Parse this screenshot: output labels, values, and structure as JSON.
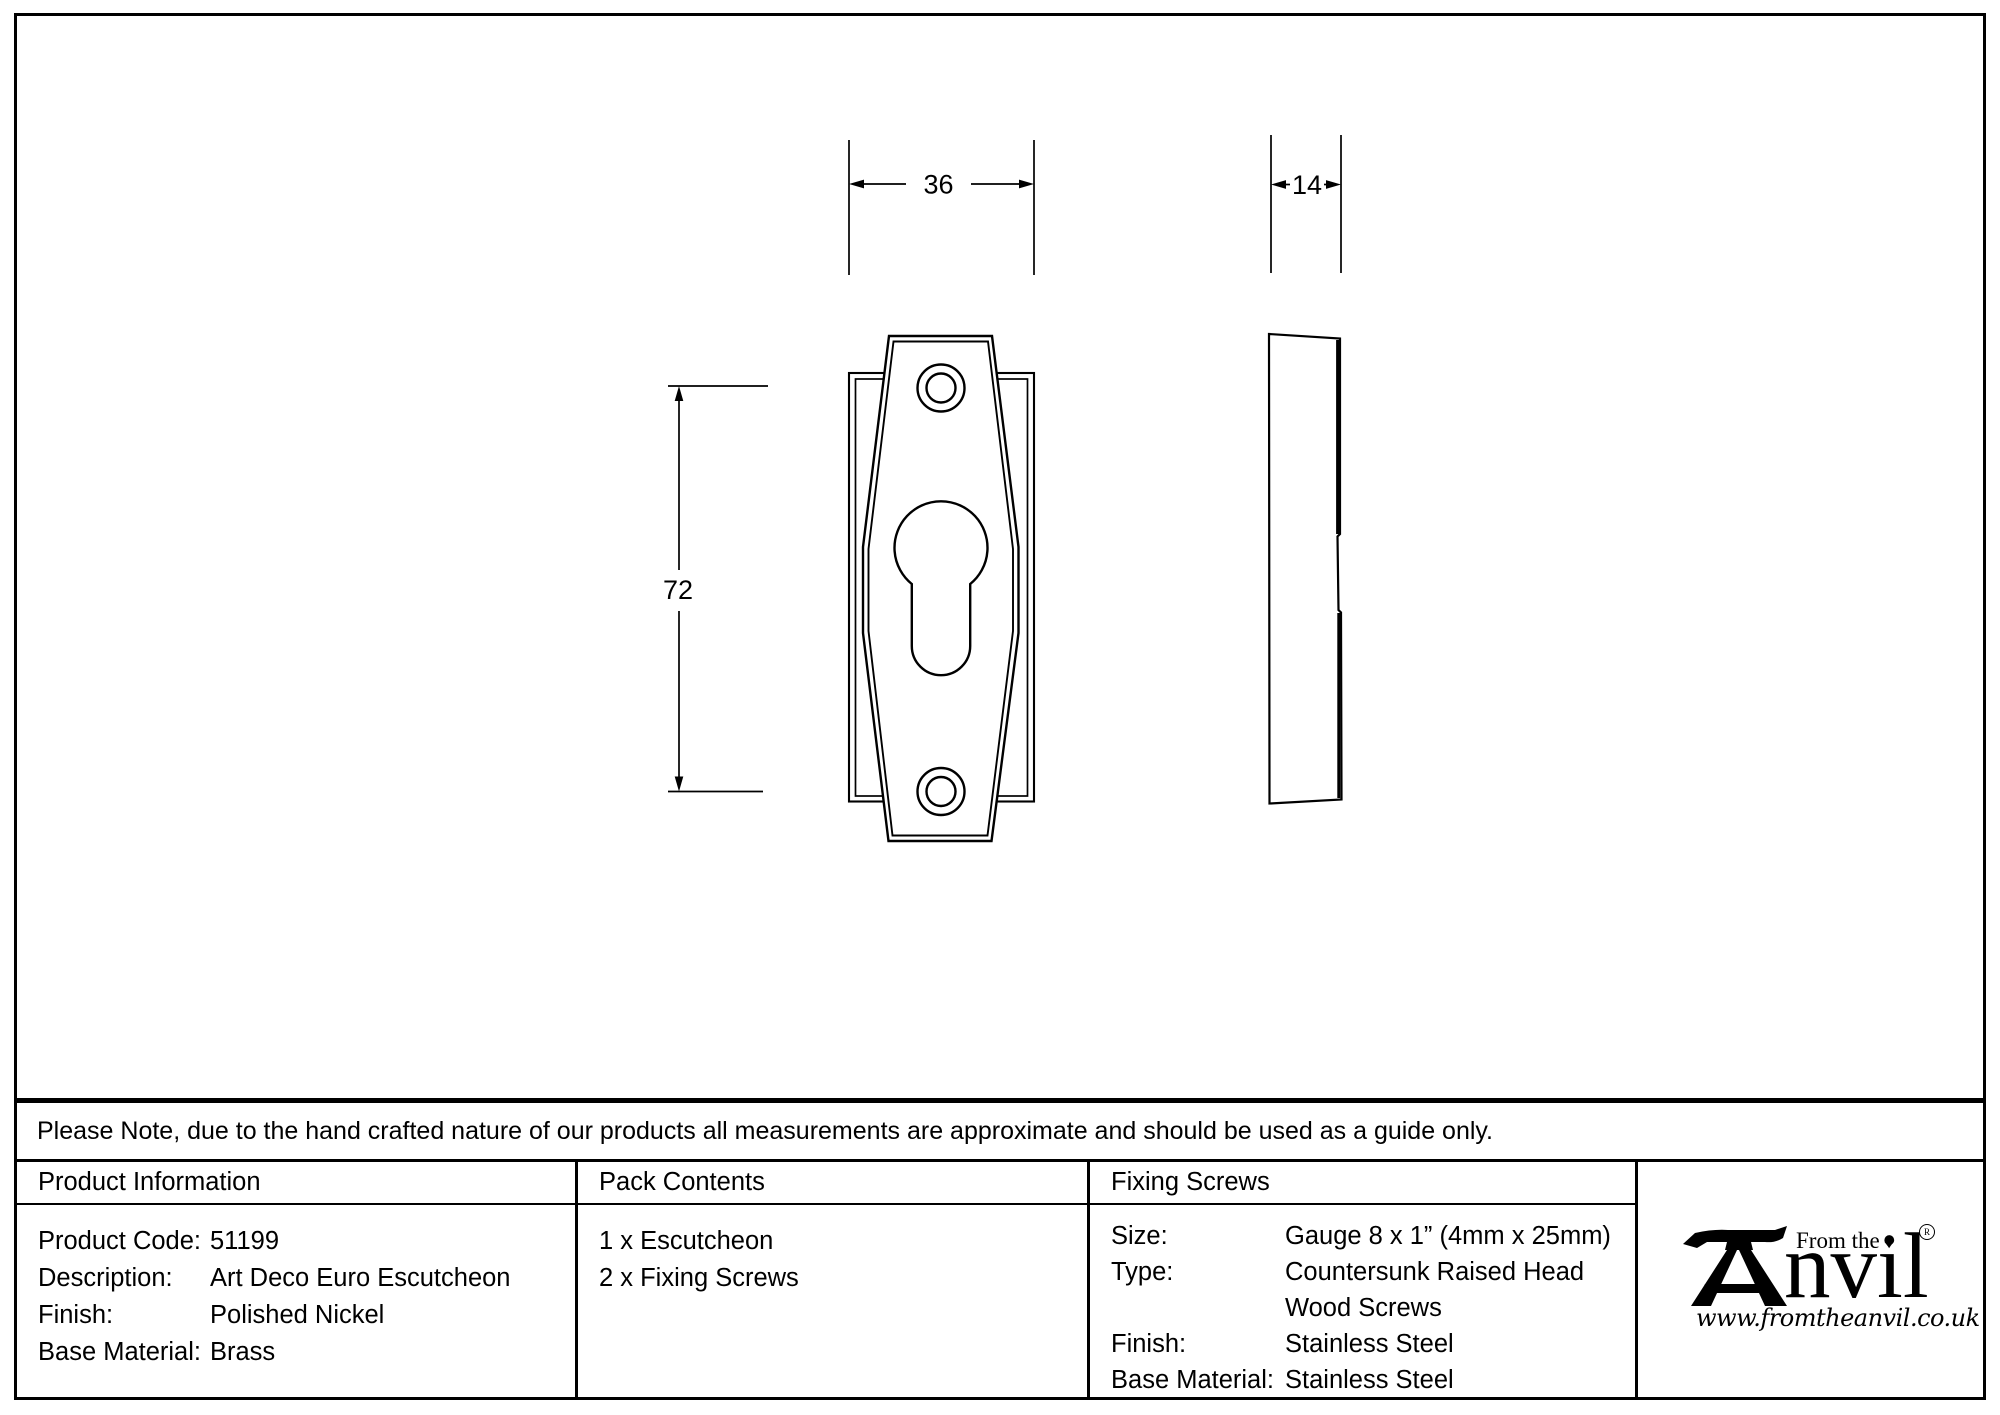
{
  "drawing": {
    "width_label": "36",
    "depth_label": "14",
    "height_label": "72"
  },
  "note": "Please Note, due to the hand crafted nature of our products all measurements are approximate and should be used as a guide only.",
  "product_information": {
    "header": "Product Information",
    "rows": [
      {
        "label": "Product Code:",
        "value": "51199"
      },
      {
        "label": "Description:",
        "value": "Art Deco Euro Escutcheon"
      },
      {
        "label": "Finish:",
        "value": "Polished Nickel"
      },
      {
        "label": "Base Material:",
        "value": "Brass"
      }
    ]
  },
  "pack_contents": {
    "header": "Pack Contents",
    "items": [
      "1 x Escutcheon",
      "2 x Fixing Screws"
    ]
  },
  "fixing_screws": {
    "header": "Fixing Screws",
    "rows": [
      {
        "label": "Size:",
        "value": "Gauge 8 x 1” (4mm x 25mm)"
      },
      {
        "label": "Type:",
        "value": "Countersunk Raised Head"
      },
      {
        "label": "",
        "value": "Wood Screws"
      },
      {
        "label": "Finish:",
        "value": "Stainless Steel"
      },
      {
        "label": "Base Material:",
        "value": "Stainless Steel"
      }
    ]
  },
  "logo": {
    "tagline": "From the",
    "diamond": "♦",
    "brand": "nvil",
    "registered": "®",
    "website": "www.fromtheanvil.co.uk"
  }
}
